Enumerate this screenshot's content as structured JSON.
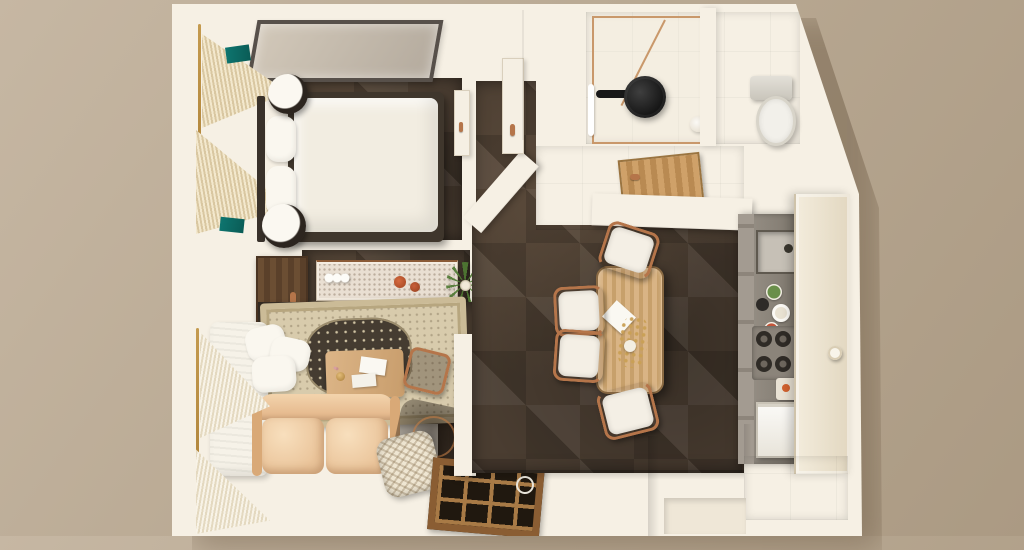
{
  "scene": {
    "type": "3d-floor-plan-top-view",
    "description": "Top-down 3D render of a one-bedroom apartment",
    "rooms": [
      {
        "name": "bedroom",
        "furniture": [
          "double-bed",
          "pillows",
          "headboard",
          "round-nightstands",
          "glass-ceiling-panel",
          "window-curtains",
          "teal-accents"
        ]
      },
      {
        "name": "study-hall",
        "furniture": [
          "open-wood-door",
          "terrazzo-console-table",
          "bottles",
          "terracotta-bowls",
          "potted-plant"
        ]
      },
      {
        "name": "living-room",
        "furniture": [
          "white-chaise",
          "throw-pillows",
          "ornate-rug",
          "wood-coffee-table",
          "books",
          "hex-side-table",
          "leather-sofa",
          "glass-side-table",
          "woven-basket",
          "wood-floor-grate",
          "window-curtains"
        ]
      },
      {
        "name": "dining-area",
        "furniture": [
          "wood-dining-table",
          "napkin",
          "gold-centerpiece",
          "chair-top",
          "chair-left-1",
          "chair-left-2",
          "chair-bottom"
        ]
      },
      {
        "name": "vestibule",
        "furniture": [
          "open-wood-door-flat",
          "ceiling-light"
        ]
      },
      {
        "name": "bathroom",
        "furniture": [
          "glass-shower-screen",
          "rain-shower-head",
          "towel-bar",
          "toilet"
        ]
      },
      {
        "name": "kitchen",
        "furniture": [
          "sink",
          "faucet",
          "plates",
          "gas-cooktop",
          "cutting-board",
          "white-appliance",
          "tall-cabinet-door",
          "cabinet-handles"
        ]
      }
    ]
  },
  "palette": {
    "bg": "#b9a993",
    "bg-light": "#c6b7a3",
    "bg-dark": "#ab9a83",
    "wall": "#f6f0e4",
    "floor-dark": "#4a3d31",
    "floor-beige": "#dcd2b8",
    "wood": "#a77a49",
    "wood-light": "#d3ac7a",
    "copper": "#b5754a",
    "gold": "#c49a4e",
    "sofa": "#eac49a",
    "rug-cream": "#d8cbac",
    "rug-dark": "#453c31",
    "teal": "#0e7670",
    "green": "#4f7a33",
    "counter": "#87807a",
    "white-soft": "#f4efe5",
    "black": "#1d1b18"
  }
}
